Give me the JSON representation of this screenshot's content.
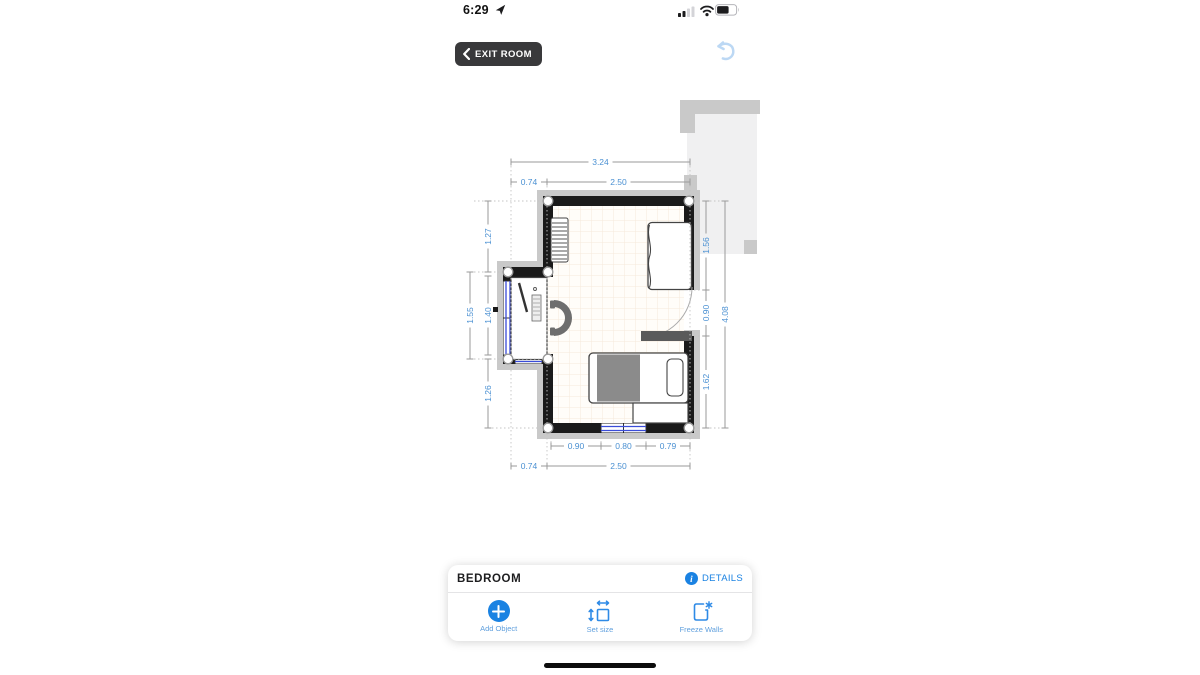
{
  "status_bar": {
    "time": "6:29"
  },
  "toolbar": {
    "exit_room_label": "EXIT ROOM"
  },
  "plan": {
    "dimensions": {
      "top_total": "3.24",
      "top_left": "0.74",
      "top_right": "2.50",
      "left_upper": "1.27",
      "left_outer": "1.55",
      "left_inner": "1.40",
      "left_lower": "1.26",
      "right_upper": "1.56",
      "right_door": "0.90",
      "right_lower": "1.62",
      "right_total": "4.08",
      "bottom_left": "0.90",
      "bottom_window": "0.80",
      "bottom_right": "0.79",
      "bottom_outer_left": "0.74",
      "bottom_outer_right": "2.50"
    }
  },
  "panel": {
    "title": "BEDROOM",
    "details_label": "DETAILS",
    "actions": [
      {
        "label": "Add Object"
      },
      {
        "label": "Set size"
      },
      {
        "label": "Freeze Walls"
      }
    ]
  },
  "colors": {
    "accent_blue": "#1a82e2",
    "dim_label_blue": "#4a90d2",
    "action_label_blue": "#5f9fdd",
    "window_blue": "#3a4cd8",
    "wall_black": "#1a1a1a",
    "wall_outer_gray": "#c9c9c9",
    "door_leaf_gray": "#5a5a5a"
  }
}
